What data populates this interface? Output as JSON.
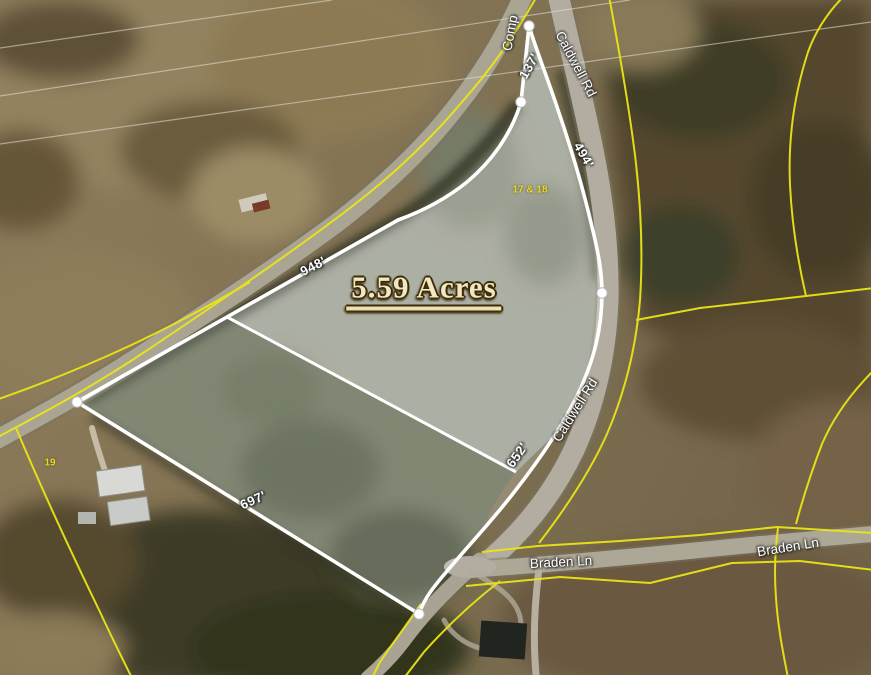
{
  "map": {
    "acreage_label": "5.59 Acres",
    "road_labels": {
      "north_road_partial": "Comp",
      "caldwell_rd_top": "Caldwell Rd",
      "caldwell_rd_mid": "Caldwell Rd",
      "braden_ln_west": "Braden Ln",
      "braden_ln_east": "Braden Ln"
    },
    "dimension_labels": {
      "top": "137'",
      "northeast": "494'",
      "northwest": "948'",
      "southeast": "652'",
      "southwest": "697'"
    },
    "parcel_labels": {
      "subject_lots": "17 & 18",
      "neighbor_lot": "19"
    },
    "colors": {
      "subject_boundary_line": "#ffffff",
      "parcel_line_yellow": "#eae516",
      "dimension_text": "#ffffff",
      "parcel_number_text": "#e9d929",
      "acreage_text": "#f1e7c3",
      "acreage_outline": "#3c2b07"
    }
  }
}
